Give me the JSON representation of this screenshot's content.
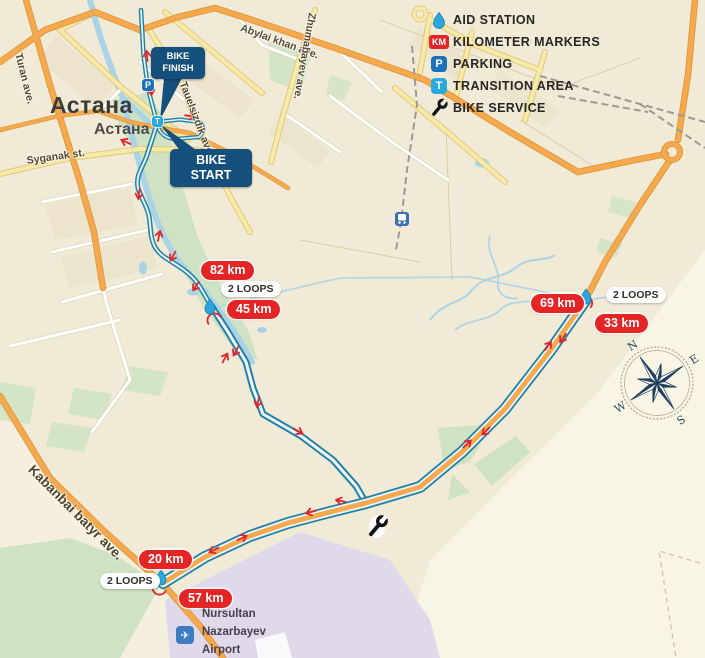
{
  "legend": {
    "aid_station": "AID STATION",
    "km_markers": "KILOMETER MARKERS",
    "parking": "PARKING",
    "transition": "TRANSITION AREA",
    "bike_service": "BIKE SERVICE",
    "km_badge": "KM",
    "parking_badge": "P",
    "transition_badge": "T"
  },
  "city": {
    "name": "Астана",
    "name_alt": "Астана"
  },
  "streets": {
    "turan": "Turan ave.",
    "syganak": "Syganak st.",
    "abylai": "Abylai khan ave.",
    "zhumabayev": "Zhumabayev ave.",
    "tauelsizdik": "Tauelsizdik ave.",
    "kabanbai": "Kabanbai batyr ave."
  },
  "course": {
    "finish_line1": "BIKE",
    "finish_line2": "FINISH",
    "start_line1": "BIKE",
    "start_line2": "START",
    "markers": [
      {
        "label": "82 km"
      },
      {
        "label": "45 km"
      },
      {
        "label": "69 km"
      },
      {
        "label": "33 km"
      },
      {
        "label": "20 km"
      },
      {
        "label": "57 km"
      }
    ],
    "loops": [
      {
        "label": "2 LOOPS"
      },
      {
        "label": "2 LOOPS"
      },
      {
        "label": "2 LOOPS"
      }
    ],
    "parking_badge": "P",
    "transition_badge": "T"
  },
  "airport": {
    "line1": "Nursultan",
    "line2": "Nazarbayev",
    "line3": "Airport"
  },
  "compass": {
    "north": "N",
    "east": "E",
    "south": "S",
    "west": "W"
  },
  "colors": {
    "route_blue": "#2381a5",
    "marker_red": "#e32526",
    "callout_navy": "#15507c",
    "parking_blue": "#1d71b8",
    "transition_blue": "#2aa9e1",
    "road_orange": "#f5a84d",
    "aid_drop_blue": "#2ba6dd"
  }
}
